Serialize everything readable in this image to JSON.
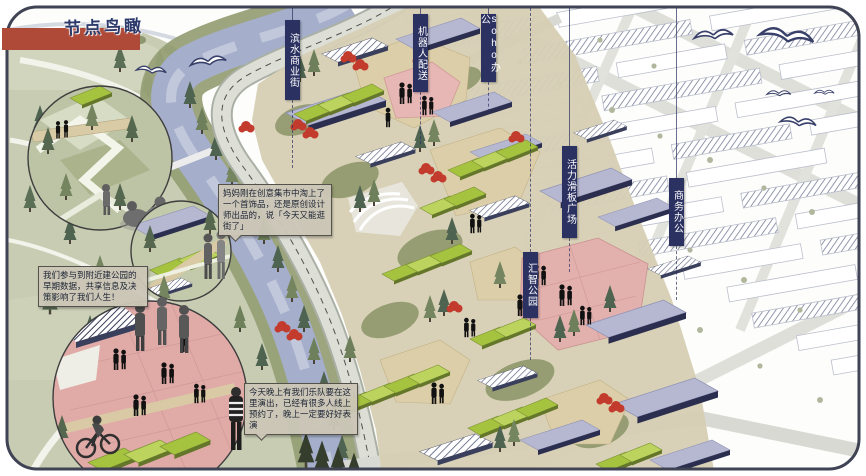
{
  "title": {
    "text": "节点鸟瞰"
  },
  "labels": [
    {
      "id": "waterfront-commercial-street",
      "text": "滨水商业街"
    },
    {
      "id": "robot-delivery",
      "text": "机器人配送"
    },
    {
      "id": "soho-office",
      "text": "soho办公"
    },
    {
      "id": "vitality-skate-plaza",
      "text": "活力滑板广场"
    },
    {
      "id": "business-office",
      "text": "商务办公"
    },
    {
      "id": "huizhi-park",
      "text": "汇智公园"
    }
  ],
  "callouts": [
    {
      "text": "妈妈刚在创意集市中淘上了一个首饰品，还是原创设计师出品的，说「今天又能逛街了」"
    },
    {
      "text": "我们参与到附近建公园的早期数据，共享信息及决策影响了我们人生！"
    },
    {
      "text": "今天晚上有我们乐队要在这里演出，已经有很多人线上预约了，晚上一定要好好表演"
    }
  ],
  "icons": {
    "birds": "gull-icon",
    "conifer": "conifer-tree-icon",
    "red_tree": "red-tree-icon",
    "people": "pedestrian-icon"
  },
  "palette": {
    "banner_navy": "#2b3160",
    "title_red": "#b04a38",
    "river_blue": "#a5aecb",
    "lawn_green": "#a6c33f",
    "roof_lavender": "#b6b8d2",
    "plaza_pink": "#e2b0ad",
    "park_green": "#c7ccb2",
    "callout_bg": "#cbc6b6"
  }
}
